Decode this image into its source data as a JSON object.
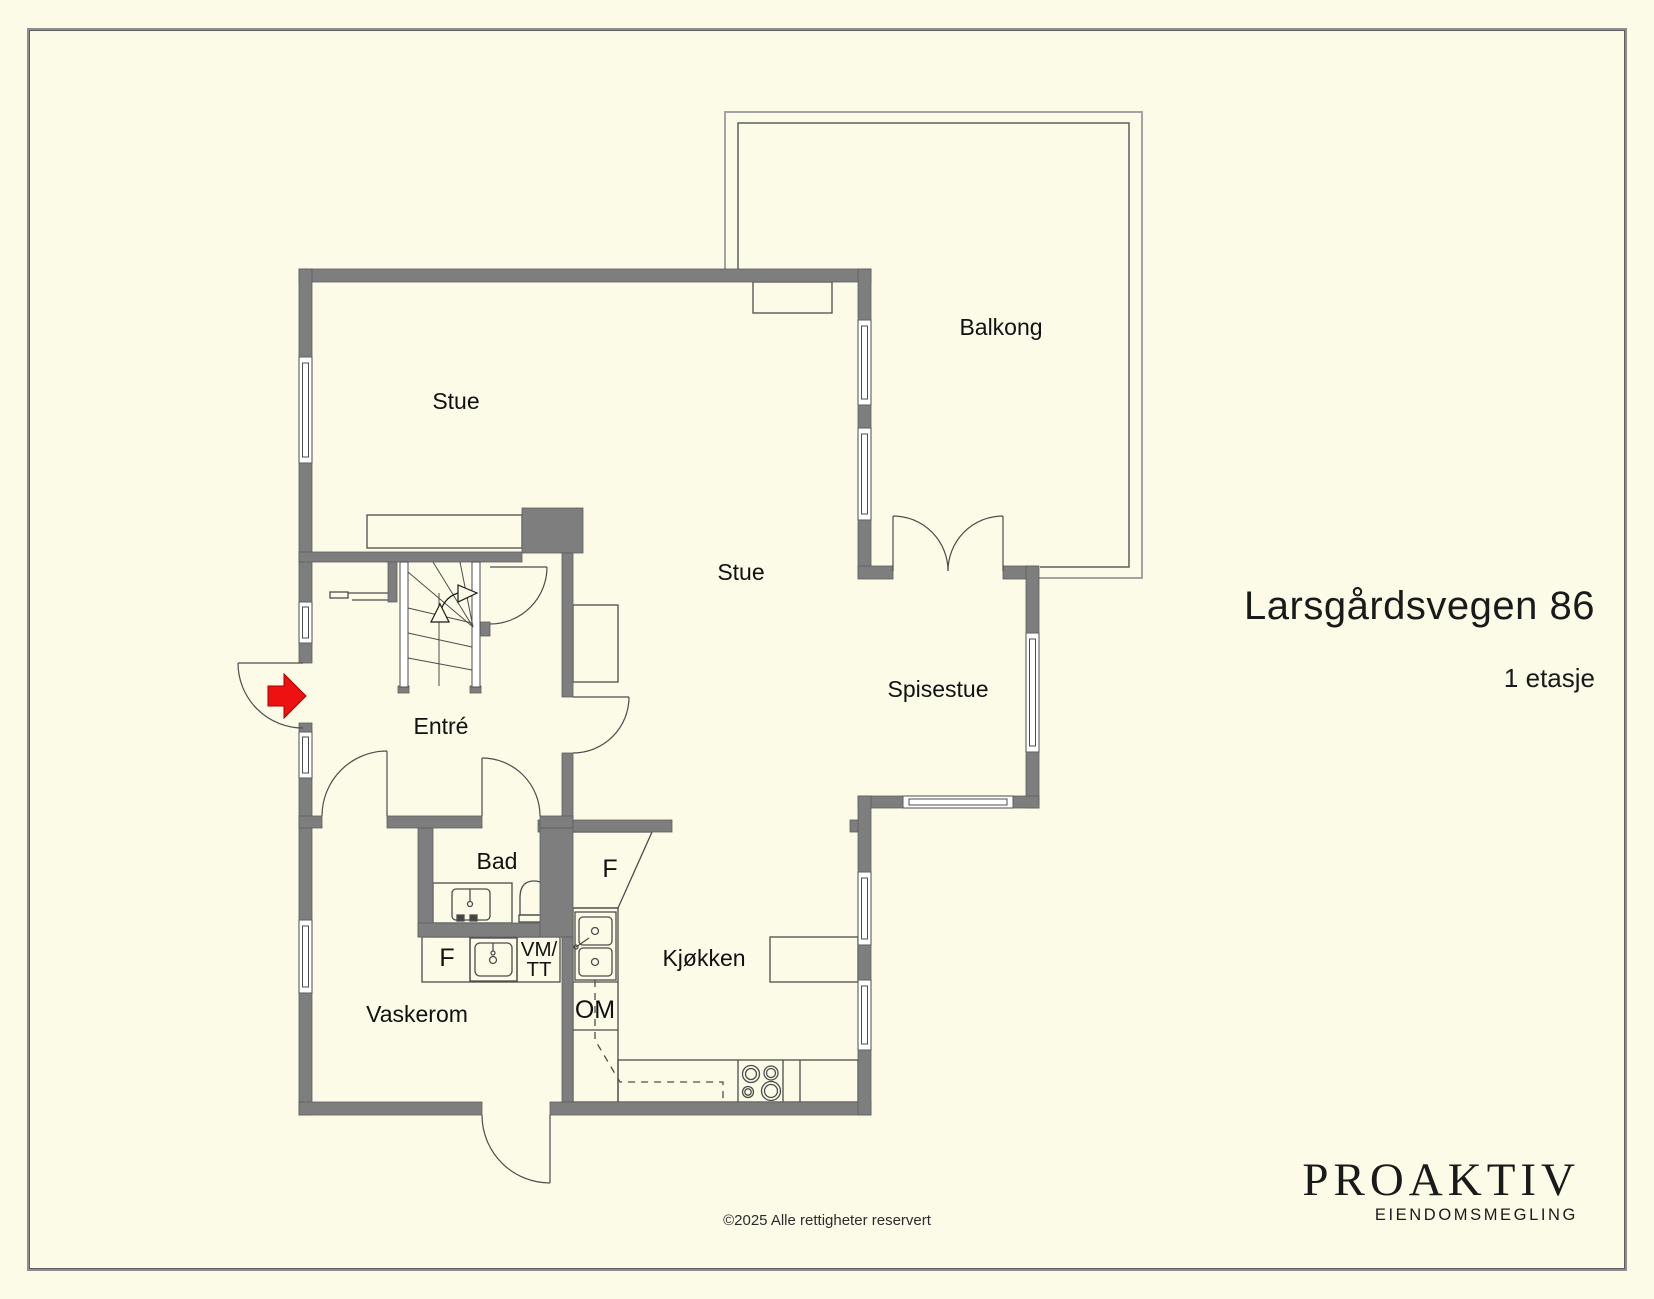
{
  "page": {
    "background_color": "#fbfbe7",
    "frame_color": "#8e8e8e"
  },
  "title_block": {
    "address": "Larsgårdsvegen 86",
    "floor": "1 etasje"
  },
  "footer": {
    "copyright": "©2025 Alle rettigheter reservert"
  },
  "logo": {
    "brand": "PROAKTIV",
    "tagline": "EIENDOMSMEGLING"
  },
  "floorplan": {
    "wall_color": "#7e7e7e",
    "line_color": "#4d4d4d",
    "entrance_arrow_color": "#ee1111",
    "rooms": [
      {
        "id": "stue-upper",
        "label": "Stue"
      },
      {
        "id": "balkong",
        "label": "Balkong"
      },
      {
        "id": "stue-center",
        "label": "Stue"
      },
      {
        "id": "spisestue",
        "label": "Spisestue"
      },
      {
        "id": "entre",
        "label": "Entré"
      },
      {
        "id": "bad",
        "label": "Bad"
      },
      {
        "id": "kjokken",
        "label": "Kjøkken"
      },
      {
        "id": "vaskerom",
        "label": "Vaskerom"
      }
    ],
    "fixtures": [
      {
        "id": "fridge-kitchen",
        "label": "F"
      },
      {
        "id": "fridge-laundry",
        "label": "F"
      },
      {
        "id": "washer-line1",
        "label": "VM/"
      },
      {
        "id": "washer-line2",
        "label": "TT"
      },
      {
        "id": "dishwasher",
        "label": "OM"
      }
    ]
  }
}
